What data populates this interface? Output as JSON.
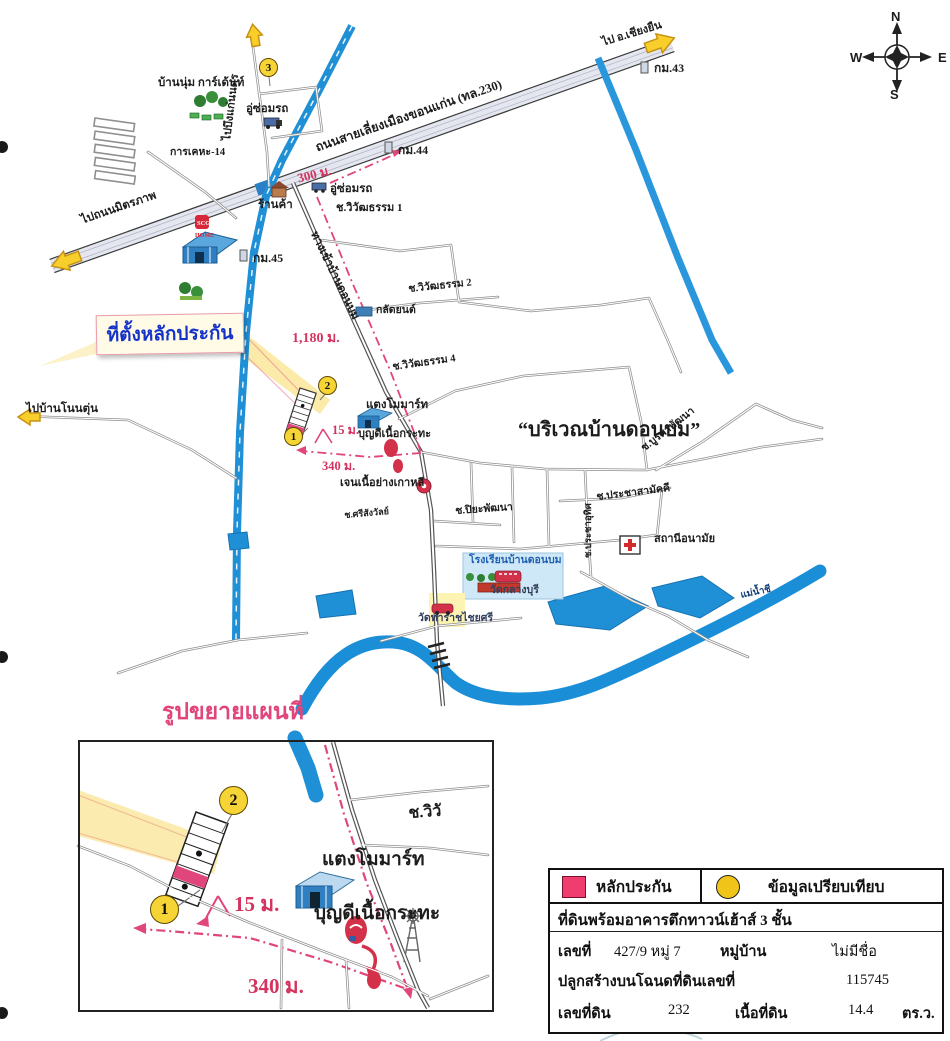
{
  "compass": {
    "north": "N",
    "south": "S",
    "east": "E",
    "west": "W"
  },
  "callout": {
    "label": "ที่ตั้งหลักประกัน"
  },
  "area_title": "“บริเวณบ้านดอนบม”",
  "roads": {
    "bypass": "ถนนสายเลี่ยงเมืองขอนแก่น (ทล.230)",
    "to_chiang_yuen": "ไป อ.เชียงยืน",
    "to_mittraphap": "ไปถนนมิตรภาพ",
    "to_bueng_kaen_nakhon": "ไปบึงแก่นนคร",
    "to_ban_non_tun": "ไปบ้านโนนตุ่น",
    "entrance": "ทางเข้าบ้านดอนบม",
    "km43": "กม.43",
    "km44": "กม.44",
    "km45": "กม.45",
    "soi_wiwat1": "ช.วิวัฒธรรม 1",
    "soi_wiwat2": "ช.วิวัฒธรรม 2",
    "soi_wiwat4": "ช.วิวัฒธรรม 4",
    "soi_burapha": "ช.บูรพาพัฒนา",
    "soi_pracha_samakkhi": "ช.ประชาสามัคคี",
    "soi_pracha_uthit": "ช.ประชาอุทิศ",
    "soi_sri_sangwan": "ช.ศรีสังวัลย์",
    "soi_piya": "ช.ปิยะพัฒนา"
  },
  "places": {
    "baan_num_garden": "บ้านนุ่ม การ์เด้นท์",
    "kan_kheha": "การเคหะ-14",
    "repair_shop1": "อู่ซ่อมรถ",
    "repair_shop2": "อู่ซ่อมรถ",
    "shop": "ร้านค้า",
    "scg_line1": "SCG",
    "scg_line2": "HOME",
    "klat_yon": "กลัดยนต์",
    "taengmo_mart": "แตงโมมาร์ท",
    "boondee": "บุญดีเนื้อกระทะ",
    "jen_bbq": "เจนเนื้อย่างเกาหลี",
    "school": "โรงเรียนบ้านดอนบม",
    "wat_klang_buri": "วัดกลางบุรี",
    "wat_tha_rat": "วัดท่าราชไชยศรี",
    "health_station": "สถานีอนามัย",
    "chi_river": "แม่น้ำชี"
  },
  "distances": {
    "d300": "300 ม.",
    "d1180": "1,180 ม.",
    "d15": "15 ม.",
    "d340": "340 ม."
  },
  "markers": {
    "m1": "1",
    "m2": "2",
    "m3": "3"
  },
  "inset": {
    "title": "รูปขยายแผนที่",
    "soi_partial": "ช.วิวั",
    "taengmo_mart": "แตงโมมาร์ท",
    "boondee": "บุญดีเนื้อกระทะ",
    "d15": "15 ม.",
    "d340": "340 ม.",
    "m1": "1",
    "m2": "2"
  },
  "legend": {
    "collateral": "หลักประกัน",
    "comparison": "ข้อมูลเปรียบเทียบ"
  },
  "property": {
    "title": "ที่ดินพร้อมอาคารตึกทาวน์เฮ้าส์ 3 ชั้น",
    "house_no_label": "เลขที่",
    "house_no": "427/9 หมู่ 7",
    "village_label": "หมู่บ้าน",
    "village": "ไม่มีชื่อ",
    "deed_label": "ปลูกสร้างบนโฉนดที่ดินเลขที่",
    "deed_no": "115745",
    "parcel_label": "เลขที่ดิน",
    "parcel_no": "232",
    "area_label": "เนื้อที่ดิน",
    "area_value": "14.4",
    "area_unit": "ตร.ว."
  },
  "colors": {
    "water": "#1f8fd6",
    "route": "#e0457b",
    "collateral_pink": "#ee3d6e",
    "marker_yellow": "#f6d435"
  }
}
